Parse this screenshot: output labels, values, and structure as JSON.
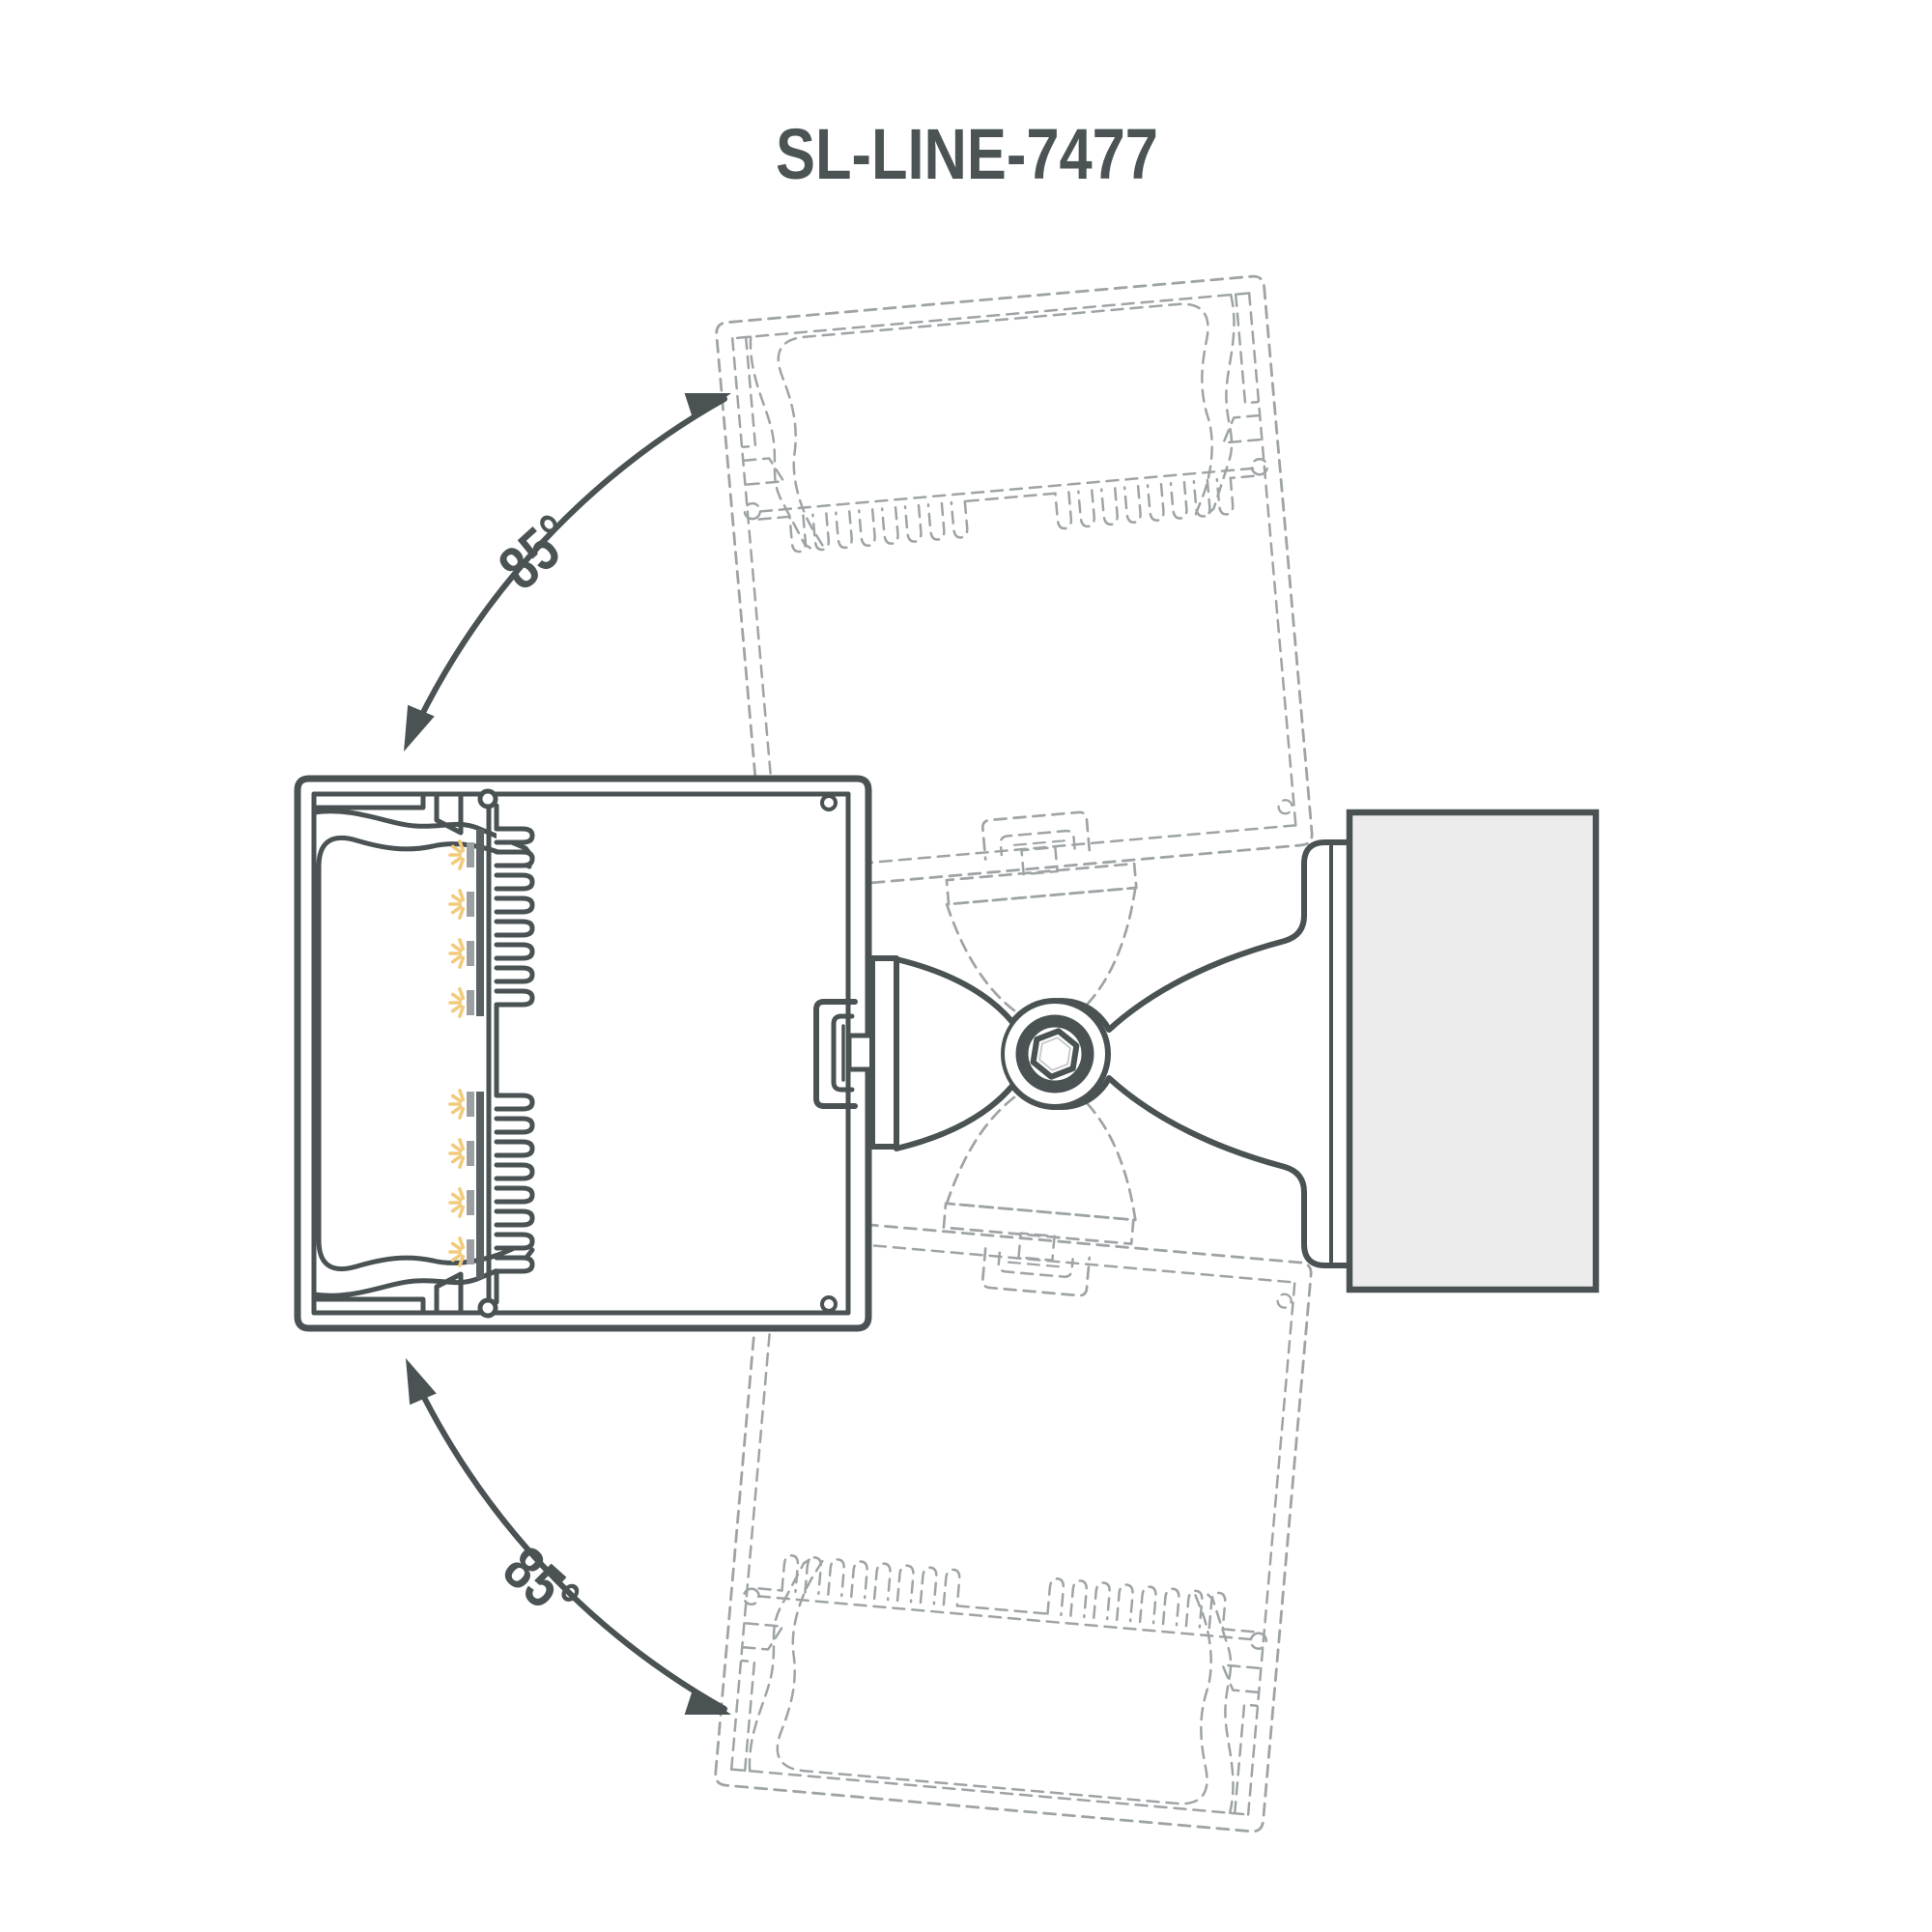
{
  "title": {
    "text": "SL-LINE-7477"
  },
  "rotation": {
    "upper_label": "85°",
    "lower_label": "85°"
  },
  "icons": {
    "pivot": "hex-socket-screw-icon",
    "upper_arrow": "rotation-arc-arrow-icon",
    "lower_arrow": "rotation-arc-arrow-icon"
  },
  "colors": {
    "bg": "#FFFFFF",
    "line": "#4A5254",
    "text": "#4B5355",
    "ghost": "#9EA4A6",
    "wall": "#ECECEC",
    "hatch": "#FFFFFF",
    "ledbar": "#5A6164",
    "module": "#9B9FA2",
    "ray": "#F2CB7D",
    "hexinner": "#C4C7C8"
  }
}
